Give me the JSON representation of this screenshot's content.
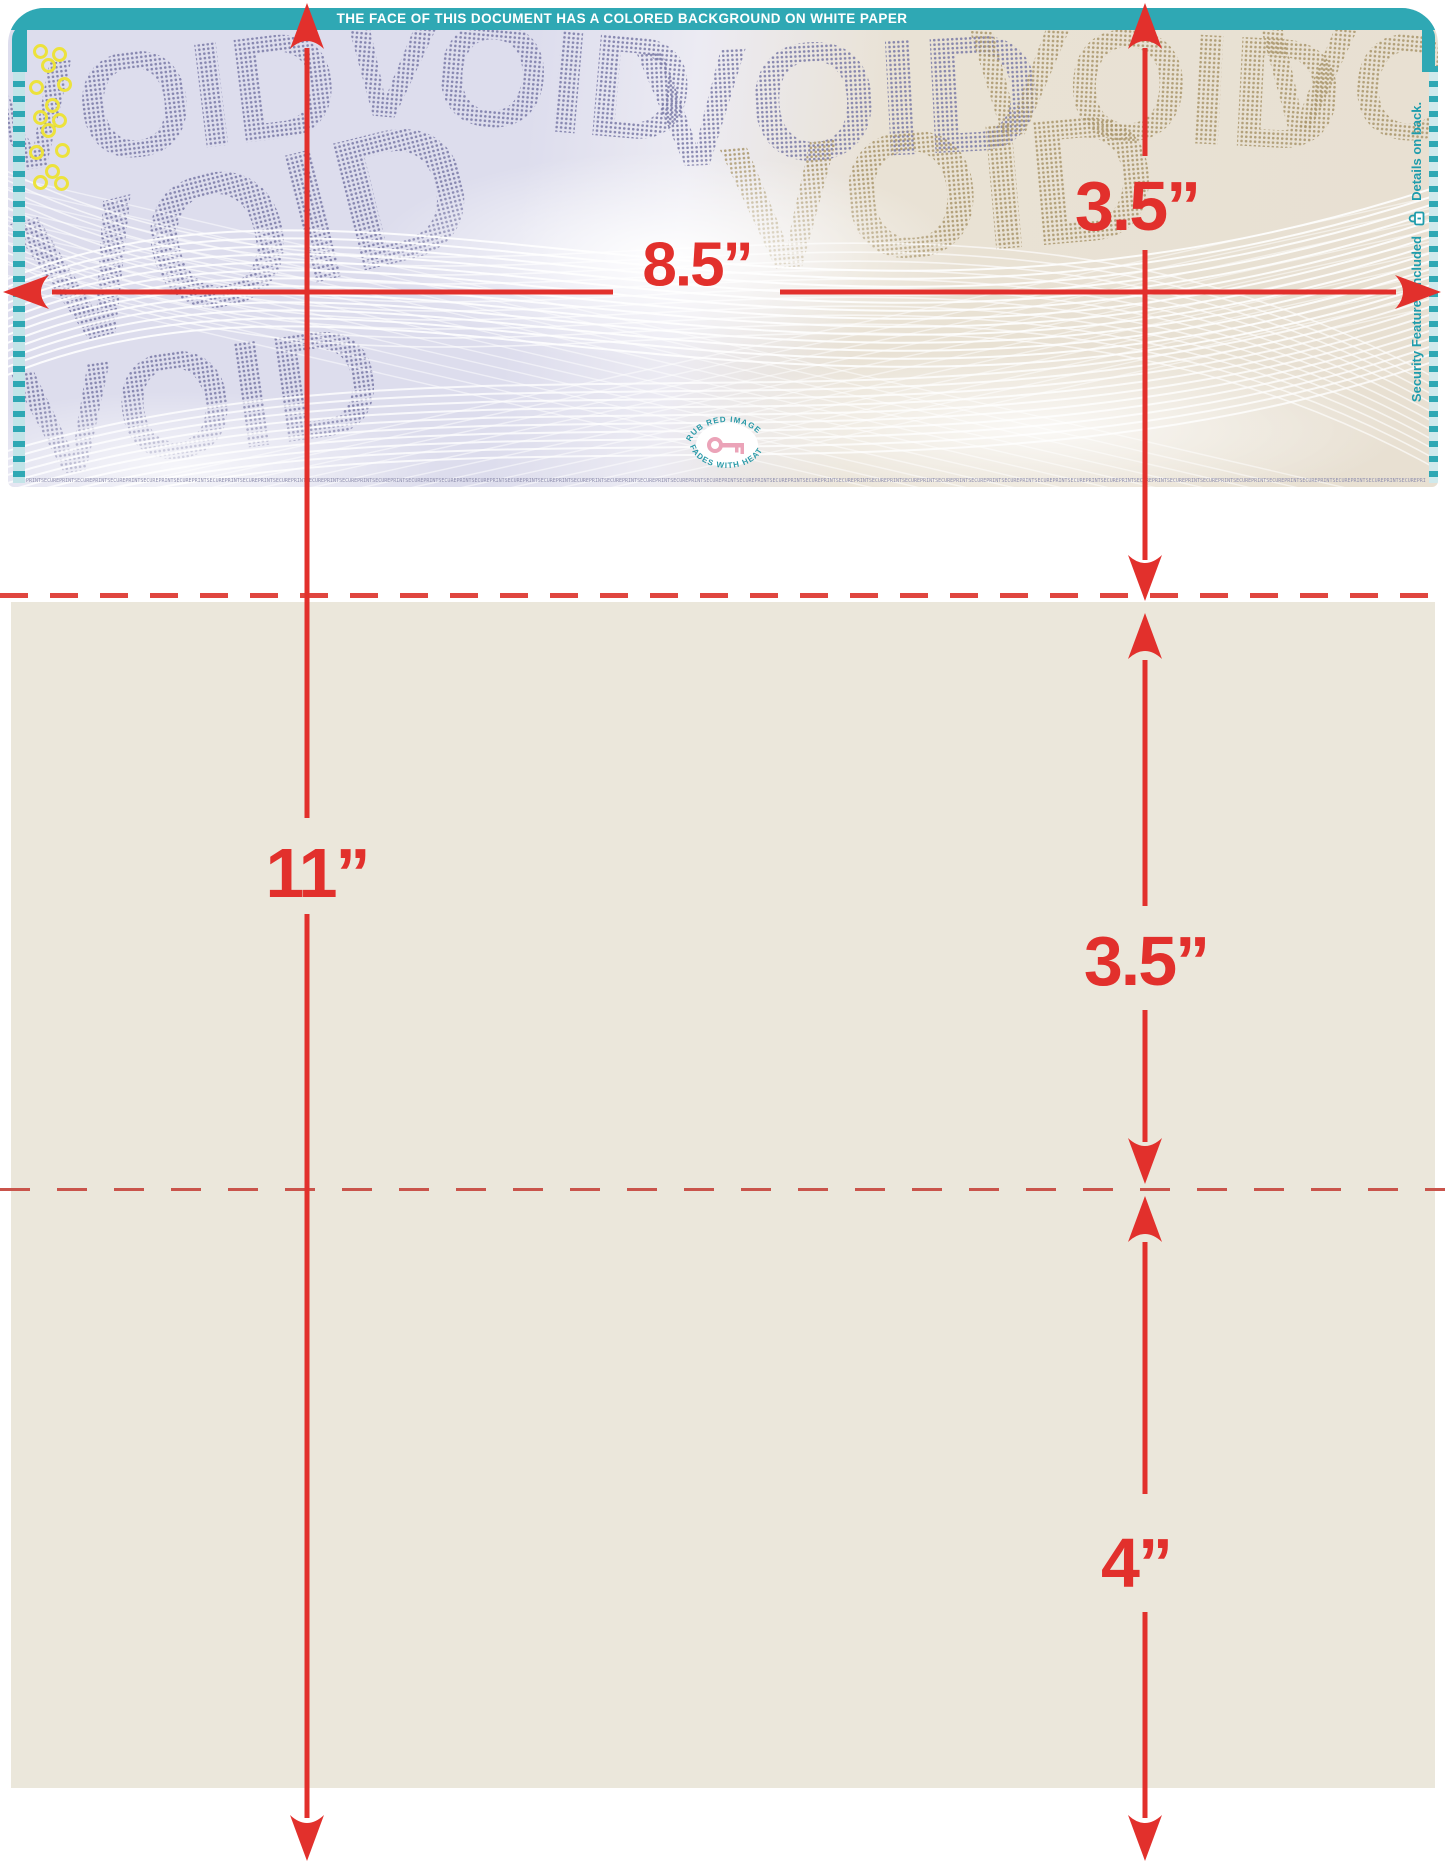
{
  "check": {
    "banner_text": "THE FACE OF THIS DOCUMENT HAS A COLORED BACKGROUND ON WHITE PAPER",
    "void_text": "VOID",
    "microtext_unit": "PRINTSECURE",
    "seal": {
      "top_text": "RUB RED IMAGE",
      "bottom_text": "FADES WITH HEAT"
    },
    "edge": {
      "security_text": "Security Features Included",
      "details_text": "Details on back."
    }
  },
  "annotations": {
    "page_width": "8.5”",
    "page_height": "11”",
    "check_height": "3.5”",
    "middle_section": "3.5”",
    "bottom_section": "4”"
  },
  "colors": {
    "dimension_red": "#e2302c",
    "perforation_red": "#e0463f",
    "teal": "#2fa8b4",
    "check_lavender": "#dddded",
    "check_tan": "#e8e0d2",
    "sheet_beige": "#ebe7db",
    "yellow_dot": "#ece23c",
    "seal_pink": "#eba3b8"
  }
}
